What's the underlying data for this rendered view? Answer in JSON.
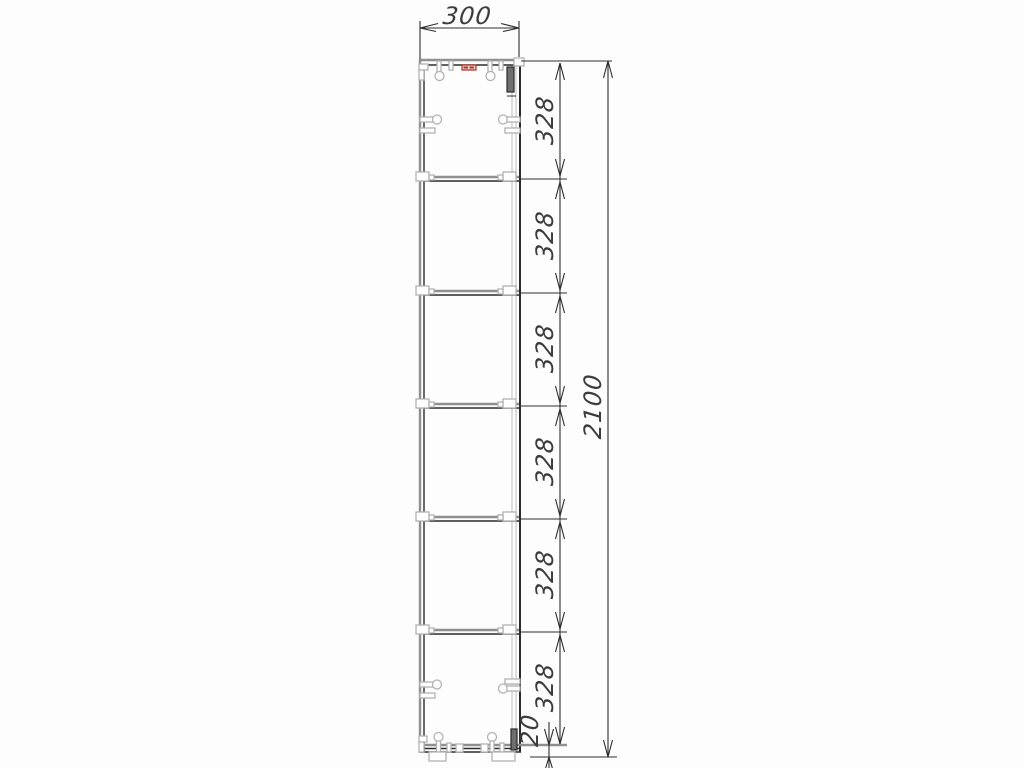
{
  "drawing": {
    "dimensions": {
      "width": "300",
      "section_heights": [
        "328",
        "328",
        "328",
        "328",
        "328",
        "328"
      ],
      "total_height": "2100",
      "plinth": "20"
    },
    "colors": {
      "line": "#2b2b2b",
      "hardware_gray": "#b2b2b2",
      "panel_gray": "#8f8f8f",
      "accent_red": "#b03a2e",
      "background": "#fdfdfd"
    }
  }
}
